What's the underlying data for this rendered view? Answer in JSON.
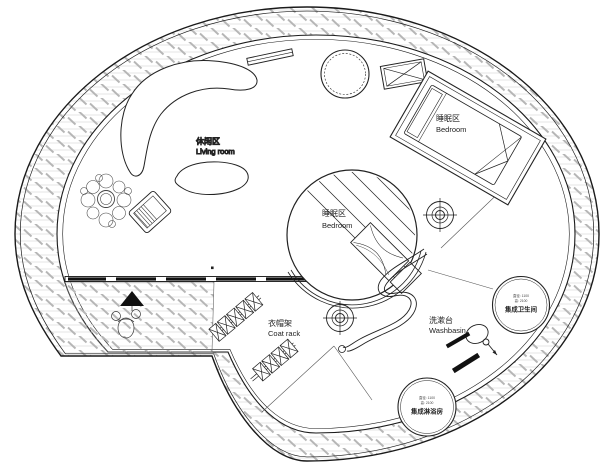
{
  "labels": {
    "living": {
      "zh": "休闲区",
      "en": "Living room"
    },
    "bedroom_top": {
      "zh": "睡眠区",
      "en": "Bedroom"
    },
    "bedroom_center": {
      "zh": "睡眠区",
      "en": "Bedroom"
    },
    "coat_rack": {
      "zh": "衣帽架",
      "en": "Coat rack"
    },
    "washbasin": {
      "zh": "洗漱台",
      "en": "Washbasin"
    },
    "bathroom_pod": {
      "dim1": "直径: 1100",
      "dim2": "高: 2100",
      "name": "集成卫生间"
    },
    "shower_pod": {
      "dim1": "直径: 1100",
      "dim2": "高: 2100",
      "name": "集成淋浴房"
    }
  },
  "colors": {
    "background": "#ffffff",
    "line": "#1a1a1a",
    "thin_line": "#555555",
    "hatch_line": "#dcdcdc",
    "hatch_dash": "#b6b6b6"
  }
}
